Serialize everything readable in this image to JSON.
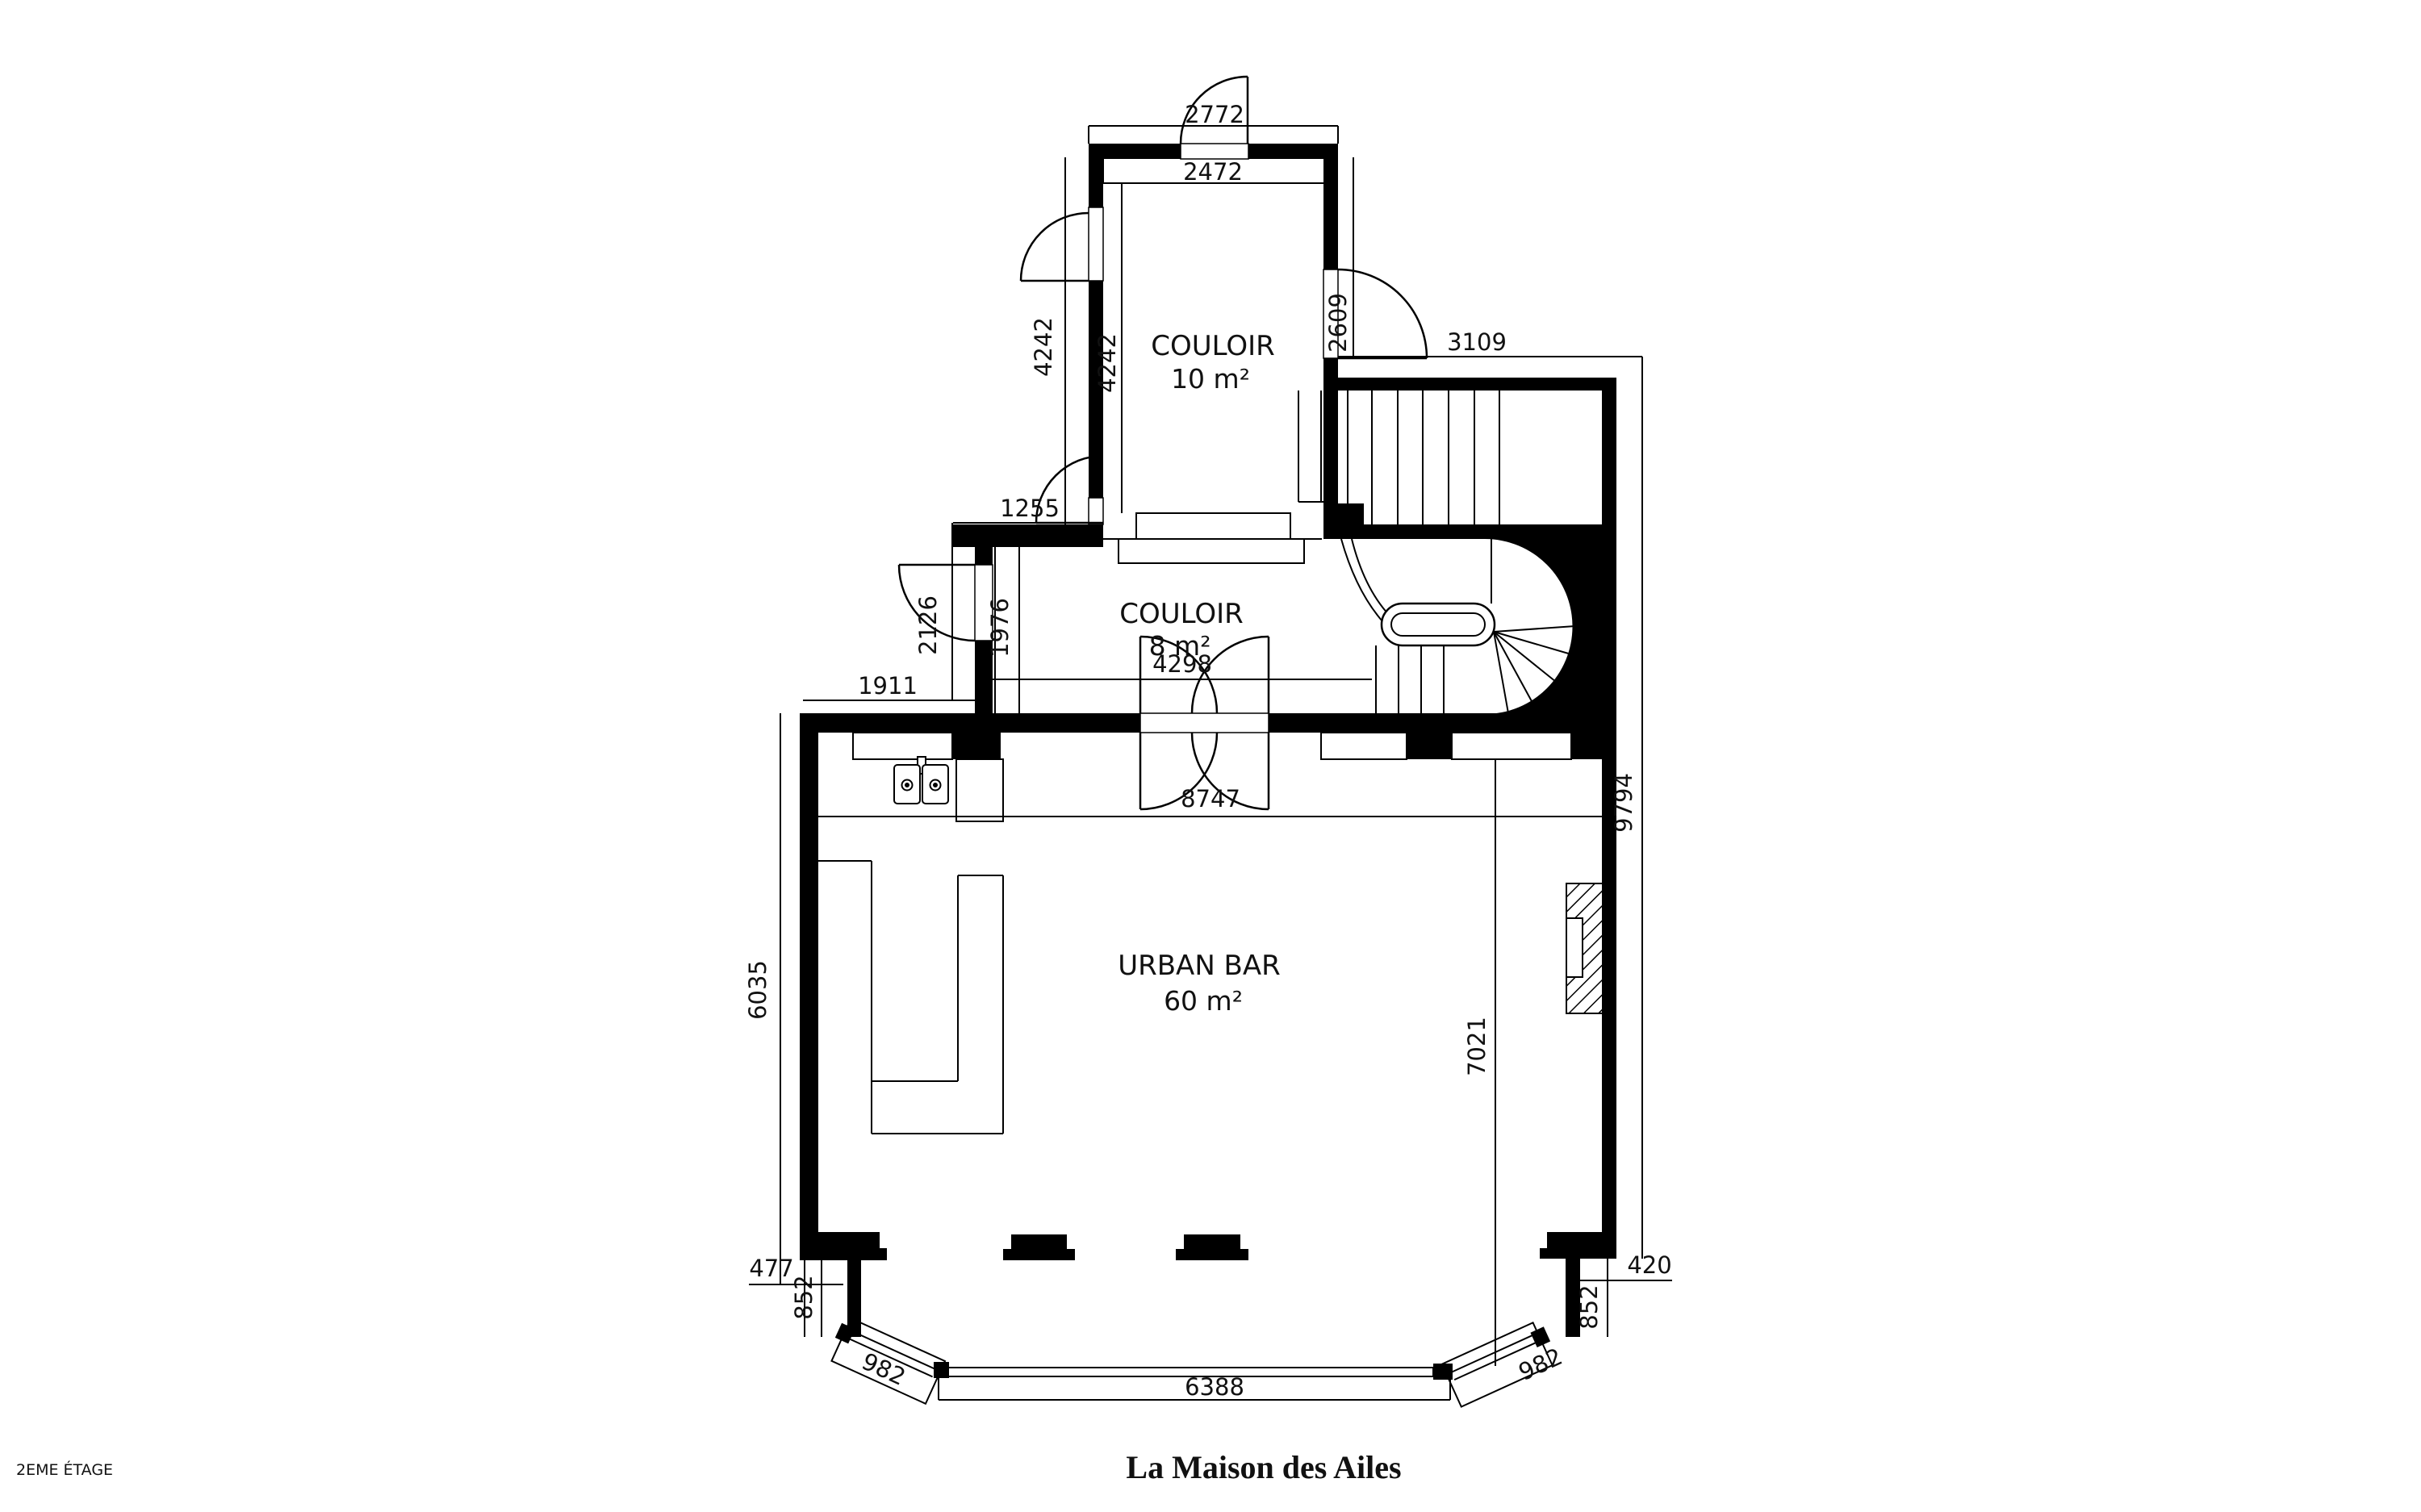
{
  "title": "La Maison des Ailes",
  "floor_label": "2EME ÉTAGE",
  "rooms": {
    "couloir_10": {
      "name": "COULOIR",
      "area": "10 m²"
    },
    "couloir_8": {
      "name": "COULOIR",
      "area": "8 m²"
    },
    "urban_bar": {
      "name": "URBAN BAR",
      "area": "60 m²"
    }
  },
  "dimensions": {
    "top_outer_width": "2772",
    "couloir10_width": "2472",
    "couloir10_height_outer": "4242",
    "couloir10_height_inner": "4242",
    "right_door": "2609",
    "stair_width": "3109",
    "couloir8_top_wall": "1255",
    "couloir8_left_wall": "2126",
    "couloir8_height": "1976",
    "left_offset": "1911",
    "couloir8_width": "4298",
    "bar_width": "8747",
    "right_height": "9794",
    "bar_left_height": "6035",
    "bar_interior_height": "7021",
    "left_corner_offset": "477",
    "left_corner_height": "852",
    "left_bay_window": "982",
    "front_window": "6388",
    "right_bay_window": "982",
    "right_corner_height": "852",
    "right_corner_offset": "420"
  }
}
